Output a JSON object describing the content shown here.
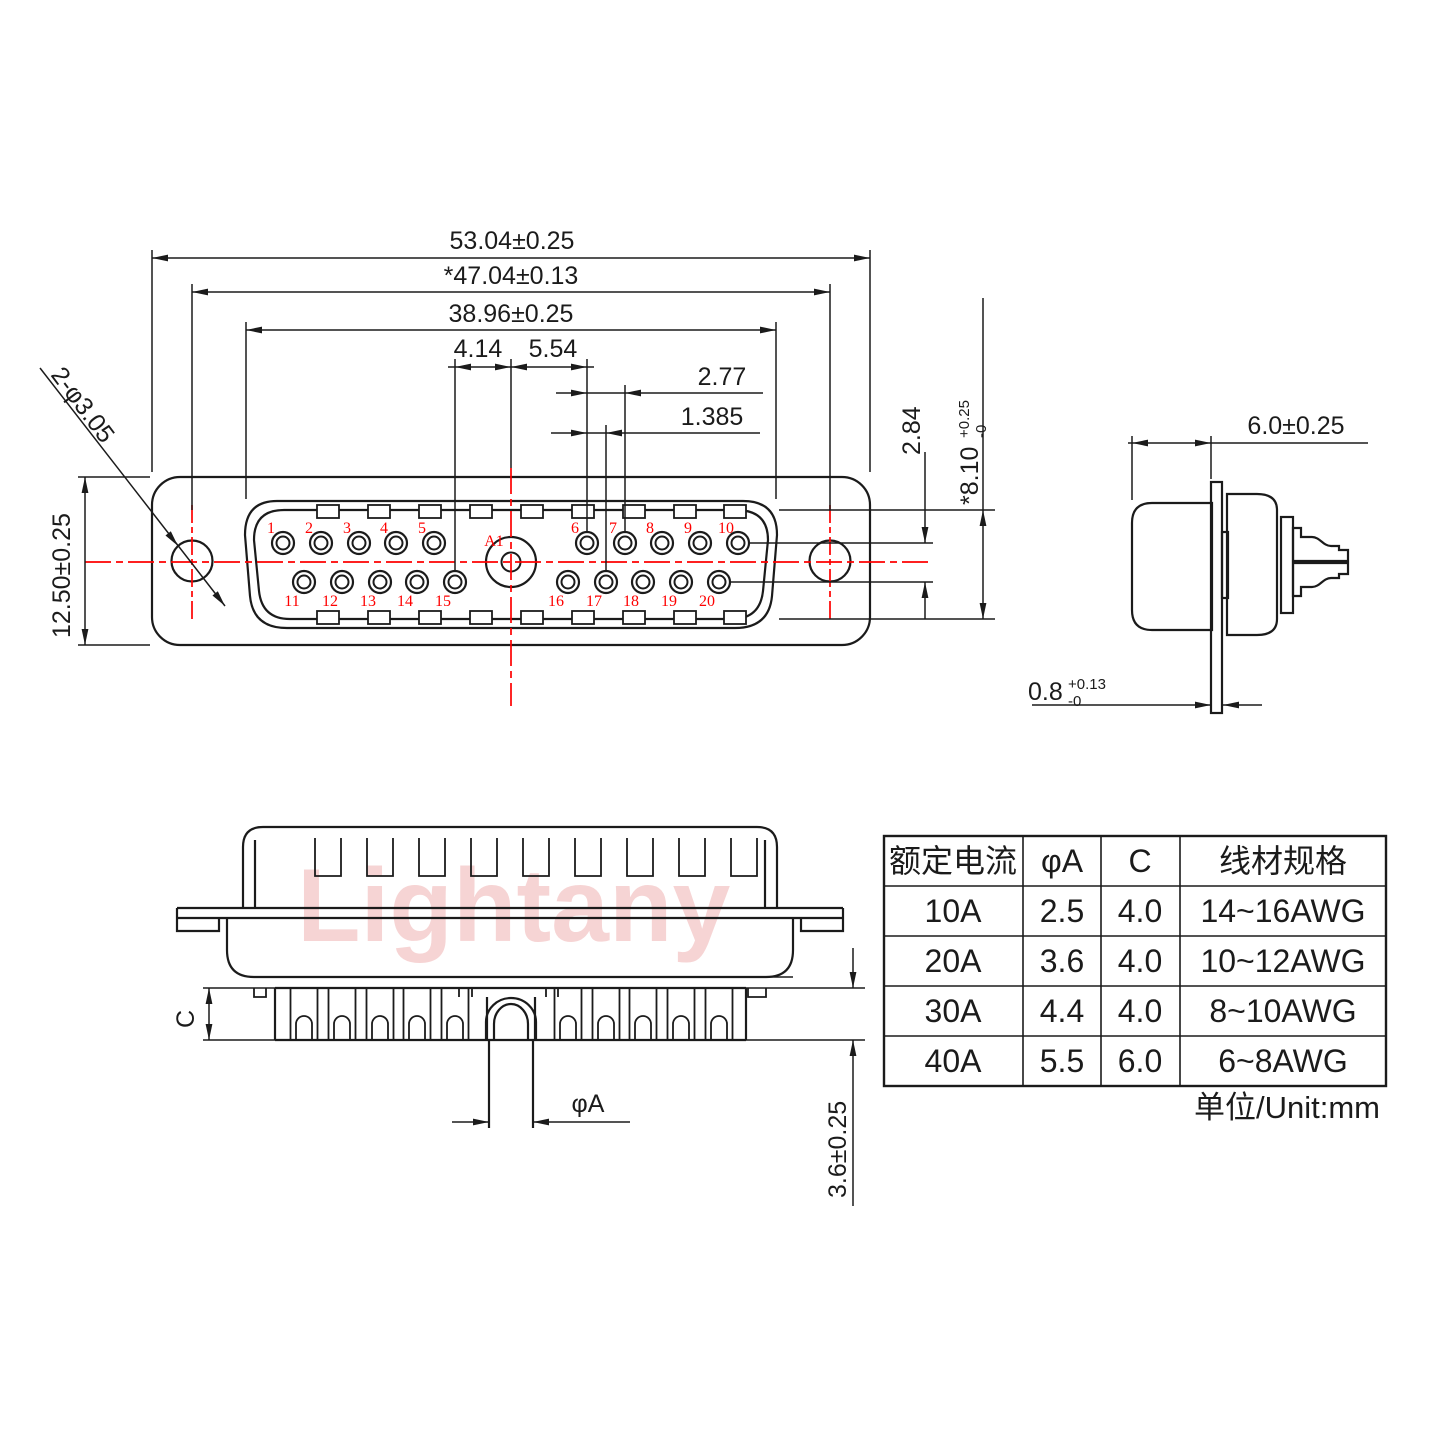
{
  "watermark": {
    "text": "Lightany",
    "color": "#e98f8f"
  },
  "front_view": {
    "dims": {
      "overall_width": "53.04±0.25",
      "hole_pitch": "*47.04±0.13",
      "shell_width": "38.96±0.25",
      "a1_to_pin15": "4.14",
      "a1_to_pin6": "5.54",
      "pin_pitch": "2.77",
      "row_stagger": "1.385",
      "row_spacing": "2.84",
      "shell_height": {
        "base": "*8.10",
        "plus": "+0.25",
        "minus": "-0"
      },
      "body_height": "12.50±0.25",
      "mounting_holes": "2-φ3.05"
    },
    "pins": {
      "top_left": [
        "1",
        "2",
        "3",
        "4",
        "5"
      ],
      "top_right": [
        "6",
        "7",
        "8",
        "9",
        "10"
      ],
      "bottom_left": [
        "11",
        "12",
        "13",
        "14",
        "15"
      ],
      "bottom_right": [
        "16",
        "17",
        "18",
        "19",
        "20"
      ],
      "center": "A1"
    }
  },
  "side_view": {
    "dims": {
      "shroud_depth": "6.0±0.25",
      "flange_thickness": {
        "base": "0.8",
        "plus": "+0.13",
        "minus": "-0"
      }
    }
  },
  "bottom_view": {
    "dims": {
      "cup_depth": "C",
      "tail_length": "3.6±0.25",
      "pin_diameter": "φA"
    }
  },
  "table": {
    "headers": [
      "额定电流",
      "φA",
      "C",
      "线材规格"
    ],
    "rows": [
      [
        "10A",
        "2.5",
        "4.0",
        "14~16AWG"
      ],
      [
        "20A",
        "3.6",
        "4.0",
        "10~12AWG"
      ],
      [
        "30A",
        "4.4",
        "4.0",
        "8~10AWG"
      ],
      [
        "40A",
        "5.5",
        "6.0",
        "6~8AWG"
      ]
    ],
    "unit_note": "单位/Unit:mm"
  }
}
